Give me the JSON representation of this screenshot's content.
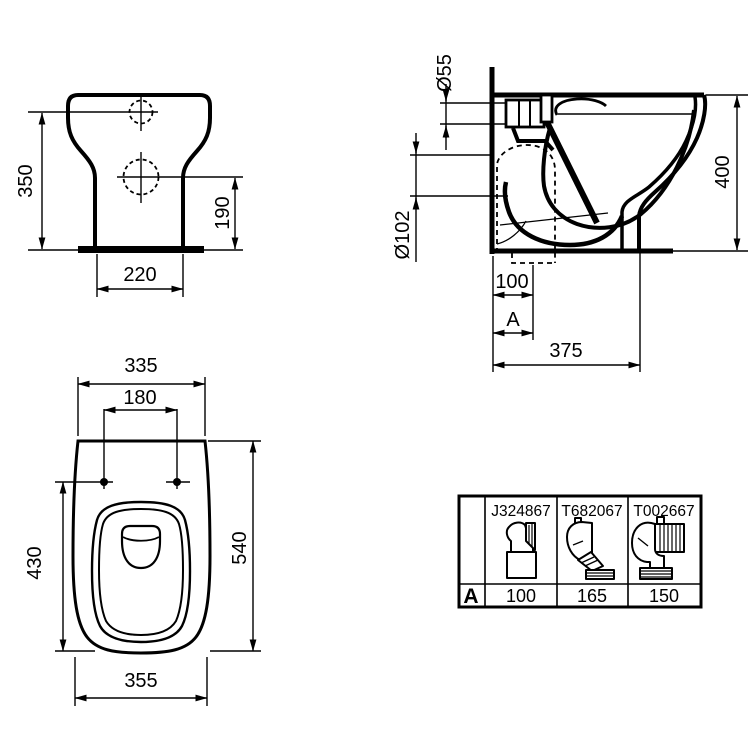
{
  "views": {
    "front": {
      "label_350": "350",
      "label_190": "190",
      "label_220": "220"
    },
    "side": {
      "label_d55": "Ø55",
      "label_d102": "Ø102",
      "label_400": "400",
      "label_100": "100",
      "label_a": "A",
      "label_375": "375"
    },
    "top": {
      "label_335": "335",
      "label_180": "180",
      "label_430": "430",
      "label_540": "540",
      "label_355": "355"
    }
  },
  "adapter_table": {
    "row_label": "A",
    "adapters": [
      {
        "code": "J324867",
        "a_value": "100"
      },
      {
        "code": "T682067",
        "a_value": "165"
      },
      {
        "code": "T002667",
        "a_value": "150"
      }
    ]
  }
}
